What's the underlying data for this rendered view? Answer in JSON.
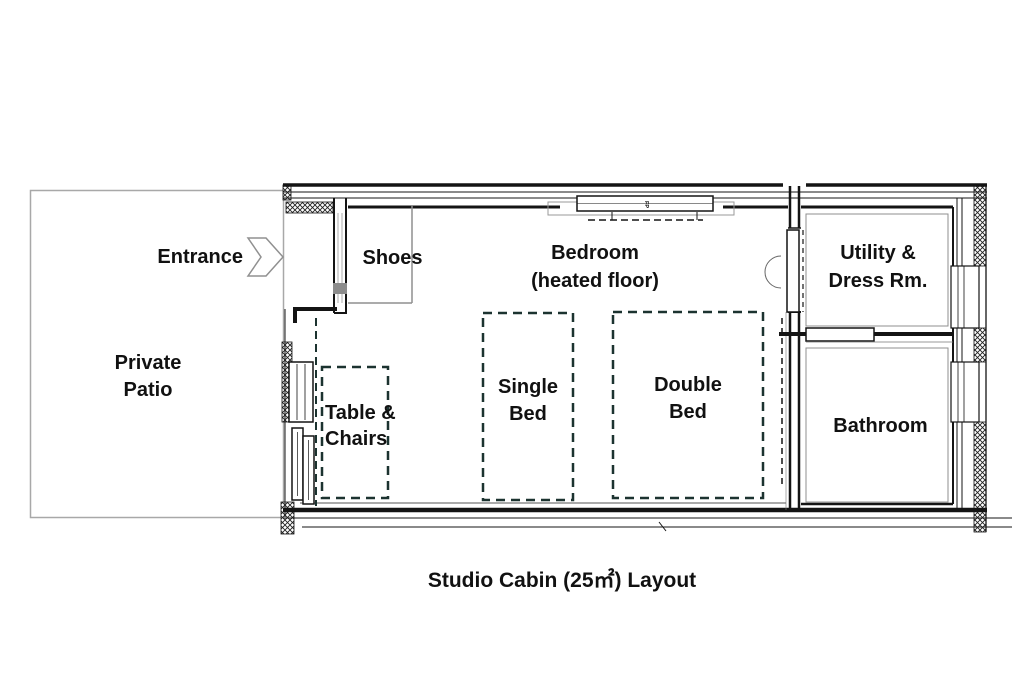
{
  "title": "Studio Cabin (25㎡) Layout",
  "outdoor": {
    "entrance_label": "Entrance",
    "patio_label": "Private Patio"
  },
  "rooms": [
    {
      "id": "bedroom",
      "label": "Bedroom",
      "sublabel": "(heated floor)"
    },
    {
      "id": "shoes",
      "label": "Shoes"
    },
    {
      "id": "utility",
      "label": "Utility & Dress Rm."
    },
    {
      "id": "bathroom",
      "label": "Bathroom"
    }
  ],
  "furniture": [
    {
      "id": "table-chairs",
      "label": "Table & Chairs"
    },
    {
      "id": "single-bed",
      "label": "Single Bed"
    },
    {
      "id": "double-bed",
      "label": "Double Bed"
    }
  ],
  "markers": {
    "window_label": "FP"
  },
  "colors": {
    "wall": "#141414",
    "gray_line": "#8f8f8f",
    "furniture_dash": "#1c3330",
    "patio_border": "#a8a8a8",
    "text": "#111111",
    "background": "#ffffff"
  }
}
